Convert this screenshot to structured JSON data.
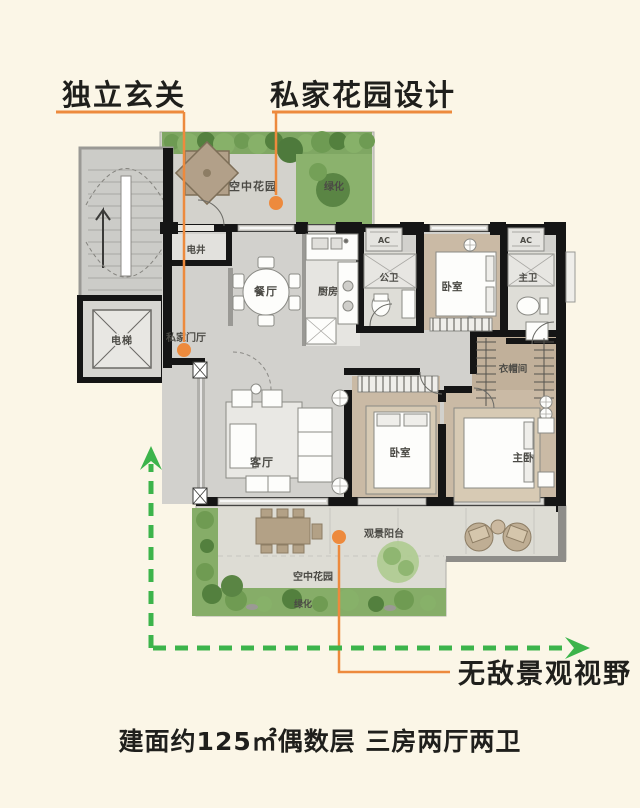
{
  "annotations": {
    "entry": "独立玄关",
    "garden": "私家花园设计",
    "view": "无敌景观视野"
  },
  "caption": "建面约125㎡偶数层 三房两厅两卫",
  "rooms": {
    "sky_garden_top": "空中花园",
    "green_top": "绿化",
    "utility_shaft": "电井",
    "elevator": "电梯",
    "private_foyer": "私家门厅",
    "dining_room": "餐厅",
    "kitchen": "厨房",
    "guest_bathroom": "公卫",
    "bedroom_north": "卧室",
    "master_bathroom": "主卫",
    "cloakroom": "衣帽间",
    "living_room": "客厅",
    "bedroom_south": "卧室",
    "master_bedroom": "主卧",
    "balcony": "观景阳台",
    "sky_garden_bottom": "空中花园",
    "green_bottom": "绿化",
    "ac_unit": "AC"
  },
  "colors": {
    "background": "#FBF6E7",
    "accent_orange": "#ED8A3D",
    "arrow_green": "#3CB44B",
    "wall_black": "#151515",
    "floor_gray": "#D2D1CD",
    "floor_wood": "#CABAA5",
    "garden_green": "#8BB26D",
    "text_black": "#1F1F1C"
  }
}
